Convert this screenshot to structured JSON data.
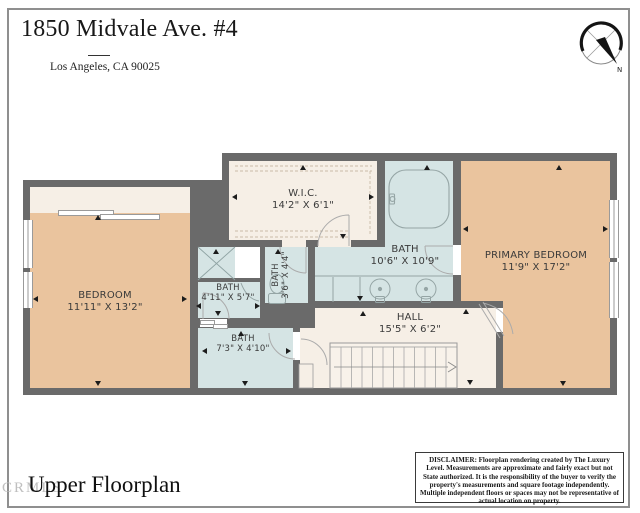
{
  "header": {
    "title": "1850 Midvale Ave. #4",
    "subtitle": "Los Angeles, CA 90025"
  },
  "compass": {
    "north_label": "N"
  },
  "rooms": {
    "wic": {
      "name": "W.I.C.",
      "dims": "14'2\" X 6'1\""
    },
    "bath_main": {
      "name": "BATH",
      "dims": "10'6\" X 10'9\""
    },
    "primary": {
      "name": "PRIMARY BEDROOM",
      "dims": "11'9\" X 17'2\""
    },
    "bedroom": {
      "name": "BEDROOM",
      "dims": "11'11\" X 13'2\""
    },
    "bath_small": {
      "name": "BATH",
      "dims": "4'11\" X 5'7\""
    },
    "bath_vertical": {
      "name": "BATH",
      "dims": "3'6\" X 4'4\""
    },
    "hall": {
      "name": "HALL",
      "dims": "15'5\" X 6'2\""
    },
    "bath_lower": {
      "name": "BATH",
      "dims": "7'3\" X 4'10\""
    }
  },
  "footer": {
    "title": "Upper Floorplan",
    "watermark": "CRMLS"
  },
  "disclaimer": {
    "text": "DISCLAIMER: Floorplan rendering created by The Luxury Level. Measurements are approximate and fairly exact but not State authorized. It is the responsibility of the buyer to verify the property's measurements and square footage independently. Multiple independent floors or spaces may not be representative of actual location on property."
  },
  "colors": {
    "wall": "#6a6a6a",
    "bedroom_floor": "#eac49e",
    "bath_floor": "#d5e4e4",
    "closet_hall_floor": "#f6efe6",
    "page_border": "#8f8f8f"
  }
}
